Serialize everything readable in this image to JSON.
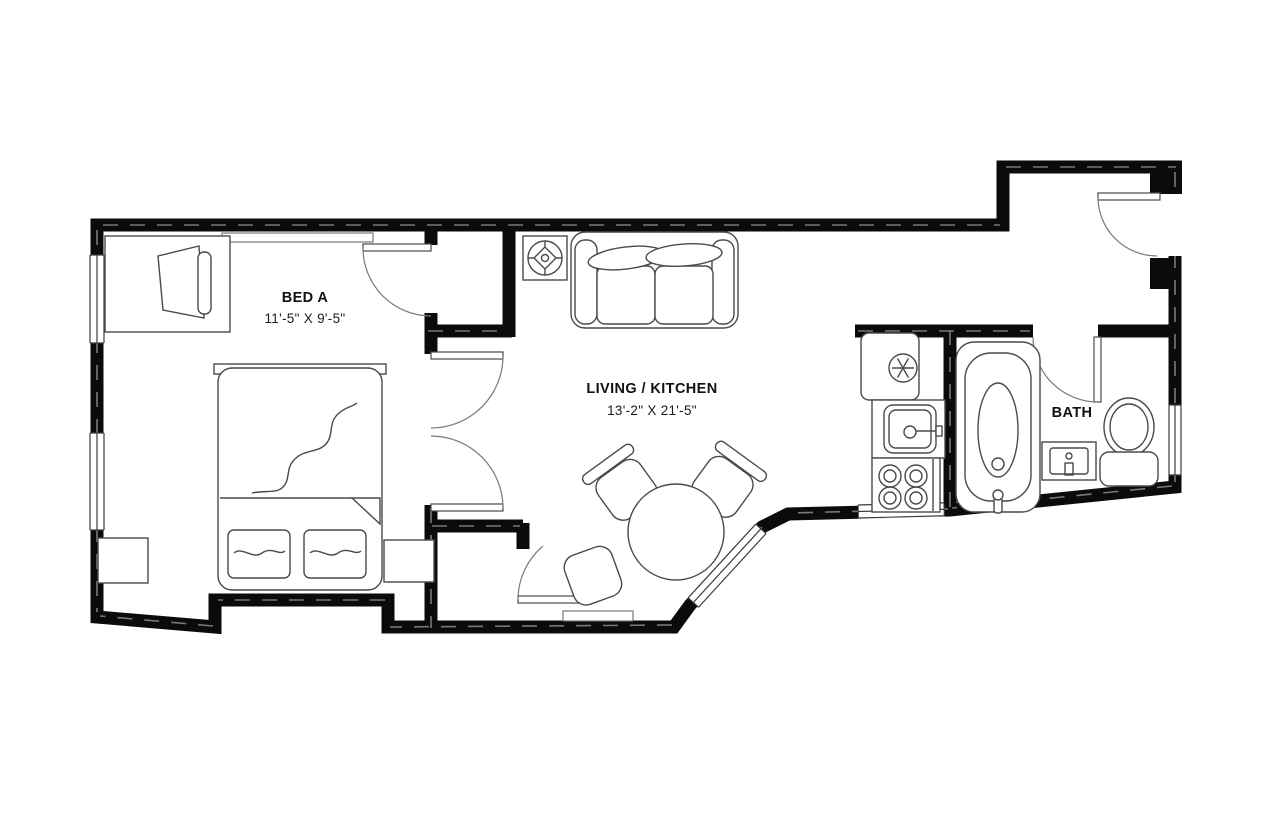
{
  "page": {
    "background": "#ffffff"
  },
  "plan": {
    "wall_color": "#0b0b0b",
    "furniture_line_color": "#4a4a4a",
    "rooms": [
      {
        "id": "bed-a",
        "name": "BED A",
        "dimensions": "11'-5\" X 9'-5\""
      },
      {
        "id": "living-kitchen",
        "name": "LIVING / KITCHEN",
        "dimensions": "13'-2\" X 21'-5\""
      },
      {
        "id": "bath",
        "name": "BATH",
        "dimensions": ""
      }
    ],
    "fixtures": [
      "desk",
      "desk-chair",
      "double-bed",
      "pillow",
      "nightstand",
      "closet-shelf",
      "ceiling-light",
      "sofa",
      "dining-table",
      "dining-chair",
      "refrigerator",
      "kitchen-sink",
      "stove",
      "bathtub",
      "vanity-sink",
      "toilet",
      "door",
      "double-door",
      "window"
    ]
  }
}
